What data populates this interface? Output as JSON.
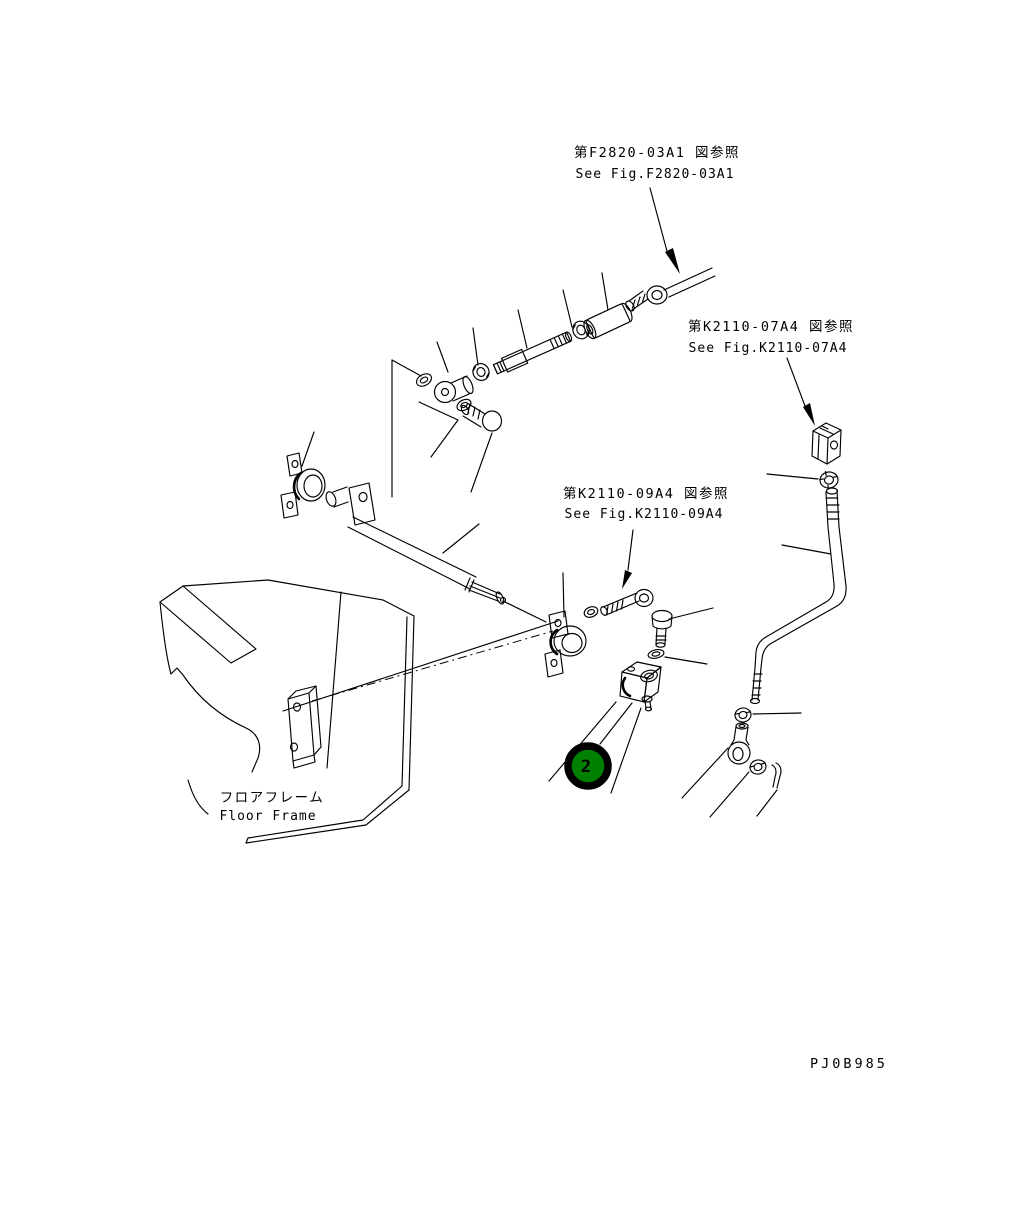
{
  "figure": {
    "references": [
      {
        "jp": "第F2820-03A1 図参照",
        "en": "See Fig.F2820-03A1"
      },
      {
        "jp": "第K2110-07A4 図参照",
        "en": "See Fig.K2110-07A4"
      },
      {
        "jp": "第K2110-09A4 図参照",
        "en": "See Fig.K2110-09A4"
      }
    ],
    "part_labels": [
      {
        "jp": "フロアフレーム",
        "en": "Floor Frame"
      }
    ],
    "callout": {
      "number": "2",
      "fill": "#008000",
      "ring": "#000000",
      "text_color": "#ffffff"
    },
    "drawing_code": "PJ0B985",
    "colors": {
      "line": "#000000",
      "background": "#ffffff"
    }
  }
}
